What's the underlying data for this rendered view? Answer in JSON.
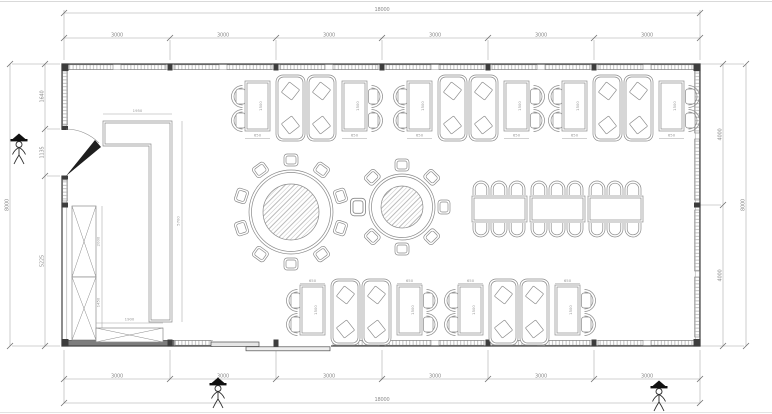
{
  "plan": {
    "dims": {
      "top_total": "18000",
      "bottom_total": "18000",
      "top_segments": [
        "3000",
        "3000",
        "3000",
        "3000",
        "3000",
        "3000"
      ],
      "bottom_segments": [
        "3000",
        "3000",
        "3000",
        "3000",
        "3000",
        "3000"
      ],
      "left_total": "8000",
      "left_segments": [
        "1640",
        "1135",
        "5225"
      ],
      "right_total": "8000",
      "right_segments": [
        "4000",
        "4000"
      ],
      "counter_width": "1950",
      "counter_length": "5700",
      "cabinet_upper": "2000",
      "cabinet_lower": "1450",
      "cabinet_bottom": "1900",
      "table_width": "650",
      "table_length": "1500"
    },
    "colors": {
      "wall": "#4f4f4f",
      "furniture_line": "#8a8a8a",
      "dimension_line": "#a3a3a3",
      "dimension_text": "#8c8c8c",
      "window_hatch": "#b0b0b0"
    }
  }
}
